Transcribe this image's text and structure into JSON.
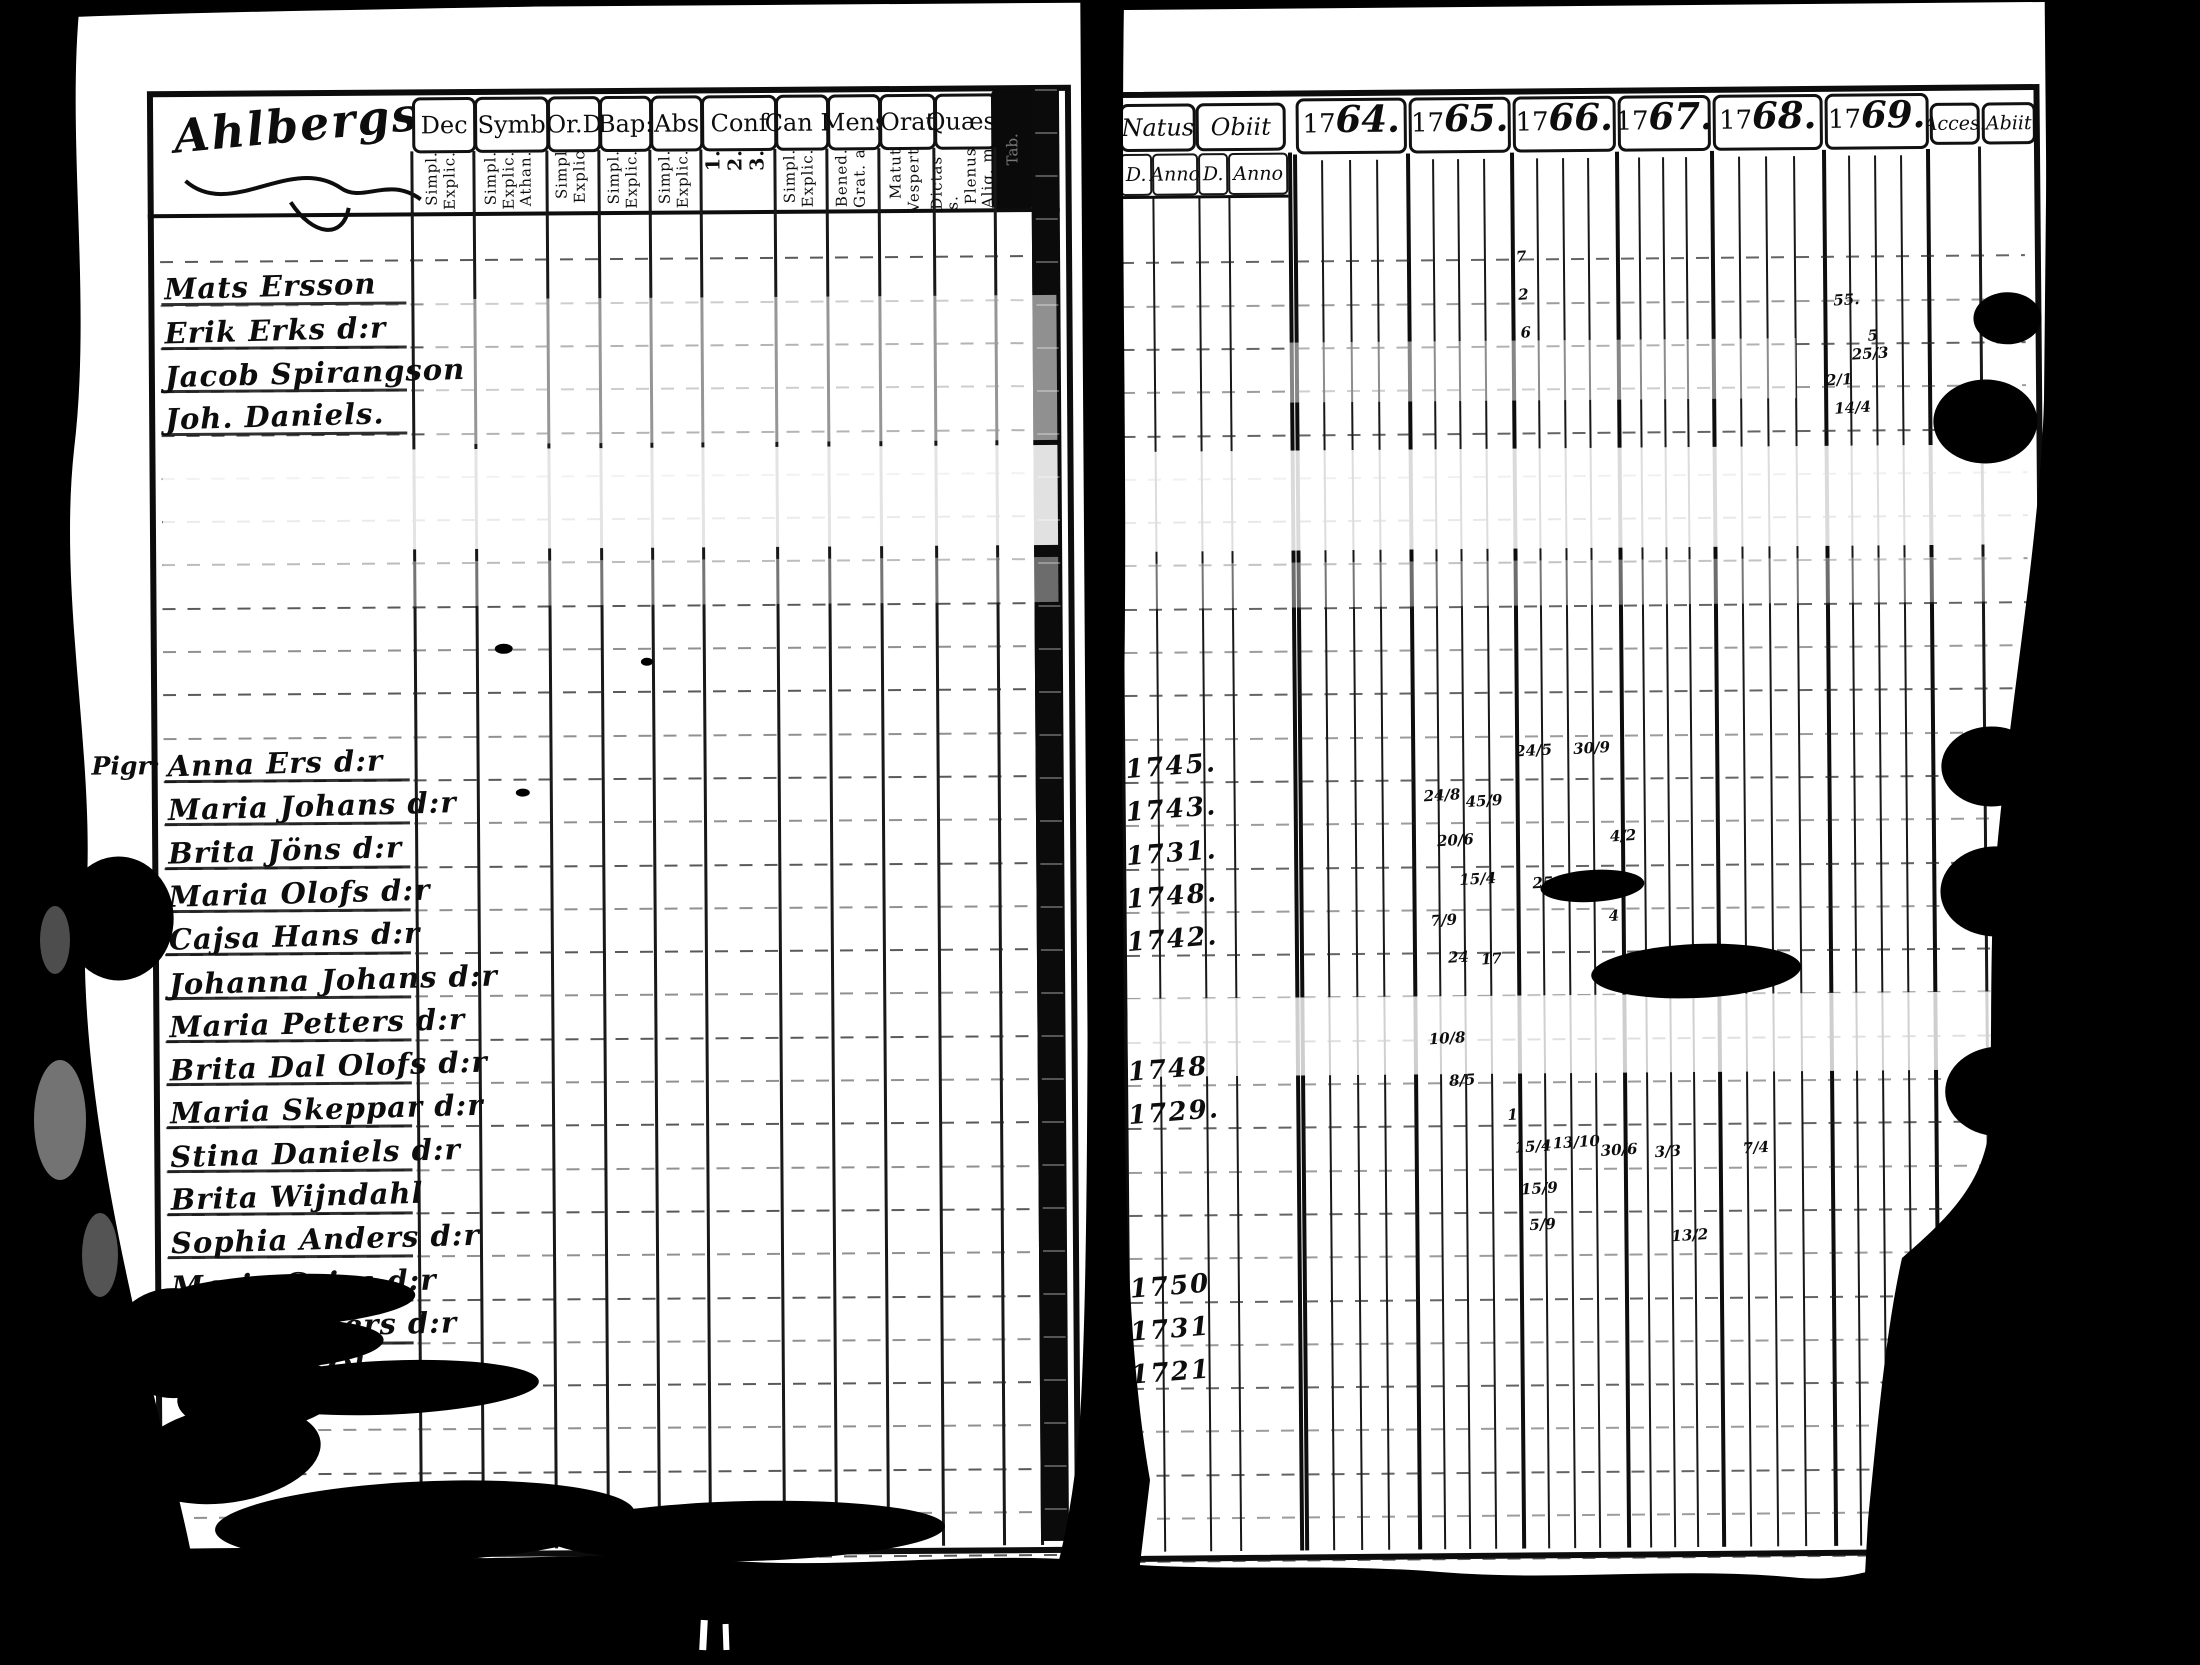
{
  "colors": {
    "paper": "#ffffff",
    "ink": "#0d0d0d"
  },
  "left_page": {
    "title": "Ahlbergs",
    "columns": [
      {
        "label": "Dec",
        "sub": "Simpl.|Explic."
      },
      {
        "label": "Symb",
        "sub": "Simpl.|Explic.|Athan."
      },
      {
        "label": "Or.D",
        "sub": "Simpl|Explic"
      },
      {
        "label": "Bap:",
        "sub": "Simpl.|Explic."
      },
      {
        "label": "Abs",
        "sub": "Simpl.|Explic."
      },
      {
        "label": "Conf",
        "sub": "1.|2.|3."
      },
      {
        "label": "Can D",
        "sub": "Simpl.|Explic."
      },
      {
        "label": "Mens",
        "sub": "Bened.|Grat. a"
      },
      {
        "label": "Orat",
        "sub": "Matut|Vespert"
      },
      {
        "label": "Quæst",
        "sub": "Dictas s.|Plenus|Aliq. m"
      },
      {
        "label": "Tab.",
        "sub": "Plenus.|Alq. m."
      }
    ],
    "margin_notes": [
      {
        "text": "Pigr:",
        "x": 92,
        "y": 748
      },
      {
        "text": "x",
        "x": 124,
        "y": 904
      }
    ],
    "entries": [
      {
        "y": 301,
        "text": "Mats Ersson"
      },
      {
        "y": 345,
        "text": "Erik Erks d:r"
      },
      {
        "y": 388,
        "text": "Jacob Spirangson"
      },
      {
        "y": 431,
        "text": "Joh. Daniels."
      },
      {
        "y": 778,
        "text": "Anna Ers d:r"
      },
      {
        "y": 821,
        "text": "Maria Johans d:r"
      },
      {
        "y": 865,
        "text": "Brita Jöns d:r"
      },
      {
        "y": 908,
        "text": "Maria Olofs d:r"
      },
      {
        "y": 951,
        "text": "Cajsa Hans d:r"
      },
      {
        "y": 995,
        "text": "Johanna Johans d:r"
      },
      {
        "y": 1038,
        "text": "Maria Petters d:r"
      },
      {
        "y": 1081,
        "text": "Brita Dal Olofs d:r"
      },
      {
        "y": 1124,
        "text": "Maria Skeppar d:r"
      },
      {
        "y": 1168,
        "text": "Stina Daniels d:r"
      },
      {
        "y": 1211,
        "text": "Brita Wijndahl"
      },
      {
        "y": 1254,
        "text": "Sophia Anders d:r"
      },
      {
        "y": 1298,
        "text": "Maria Caisa d:r"
      },
      {
        "y": 1341,
        "text": "Carin Anders d:r"
      },
      {
        "y": 1384,
        "text": "Margeta Öberg"
      }
    ]
  },
  "right_page": {
    "natus": {
      "label": "Natus",
      "d": "D.",
      "anno": "Anno"
    },
    "obiit": {
      "label": "Obiit",
      "d": "D.",
      "anno": "Anno"
    },
    "years": [
      {
        "prefix": "17",
        "suffix": "64."
      },
      {
        "prefix": "17",
        "suffix": "65."
      },
      {
        "prefix": "17",
        "suffix": "66."
      },
      {
        "prefix": "17",
        "suffix": "67."
      },
      {
        "prefix": "17",
        "suffix": "68."
      },
      {
        "prefix": "17",
        "suffix": "69."
      }
    ],
    "acces_label": "Acces.",
    "abiit_label": "Abiit",
    "birth_years": [
      {
        "y": 778,
        "text": "1745."
      },
      {
        "y": 821,
        "text": "1743."
      },
      {
        "y": 865,
        "text": "1731."
      },
      {
        "y": 908,
        "text": "1748."
      },
      {
        "y": 951,
        "text": "1742."
      },
      {
        "y": 1081,
        "text": "1748"
      },
      {
        "y": 1124,
        "text": "1729."
      },
      {
        "y": 1298,
        "text": "1750"
      },
      {
        "y": 1341,
        "text": "1731"
      },
      {
        "y": 1384,
        "text": "1721"
      }
    ],
    "marks": [
      {
        "x": 1521,
        "y": 262,
        "t": "7"
      },
      {
        "x": 1523,
        "y": 300,
        "t": "2"
      },
      {
        "x": 1525,
        "y": 338,
        "t": "6"
      },
      {
        "x": 1838,
        "y": 308,
        "t": "55."
      },
      {
        "x": 1872,
        "y": 344,
        "t": "5"
      },
      {
        "x": 1856,
        "y": 362,
        "t": "25/3"
      },
      {
        "x": 1830,
        "y": 388,
        "t": "2/1"
      },
      {
        "x": 1838,
        "y": 416,
        "t": "14/4"
      },
      {
        "x": 1516,
        "y": 756,
        "t": "24/5"
      },
      {
        "x": 1574,
        "y": 754,
        "t": "30/9"
      },
      {
        "x": 1424,
        "y": 800,
        "t": "24/8"
      },
      {
        "x": 1466,
        "y": 806,
        "t": "45/9"
      },
      {
        "x": 1437,
        "y": 845,
        "t": "20/6"
      },
      {
        "x": 1610,
        "y": 842,
        "t": "4/2"
      },
      {
        "x": 1459,
        "y": 884,
        "t": "15/4"
      },
      {
        "x": 1532,
        "y": 888,
        "t": "25/8"
      },
      {
        "x": 1430,
        "y": 925,
        "t": "7/9"
      },
      {
        "x": 1608,
        "y": 922,
        "t": "4"
      },
      {
        "x": 1447,
        "y": 962,
        "t": "24"
      },
      {
        "x": 1480,
        "y": 964,
        "t": "17"
      },
      {
        "x": 1427,
        "y": 1043,
        "t": "10/8"
      },
      {
        "x": 1447,
        "y": 1085,
        "t": "8/5"
      },
      {
        "x": 1505,
        "y": 1120,
        "t": "1"
      },
      {
        "x": 1512,
        "y": 1152,
        "t": "15/4"
      },
      {
        "x": 1550,
        "y": 1148,
        "t": "13/10"
      },
      {
        "x": 1598,
        "y": 1156,
        "t": "30/6"
      },
      {
        "x": 1652,
        "y": 1158,
        "t": "3/3"
      },
      {
        "x": 1740,
        "y": 1155,
        "t": "7/4"
      },
      {
        "x": 1518,
        "y": 1194,
        "t": "15/9"
      },
      {
        "x": 1526,
        "y": 1230,
        "t": "5/9"
      },
      {
        "x": 1668,
        "y": 1242,
        "t": "13/2"
      },
      {
        "x": 1950,
        "y": 1272,
        "t": "25/3"
      },
      {
        "x": 1948,
        "y": 1312,
        "t": "2/4"
      },
      {
        "x": 1950,
        "y": 1352,
        "t": "25/7"
      },
      {
        "x": 1948,
        "y": 1392,
        "t": "24/9"
      }
    ]
  }
}
